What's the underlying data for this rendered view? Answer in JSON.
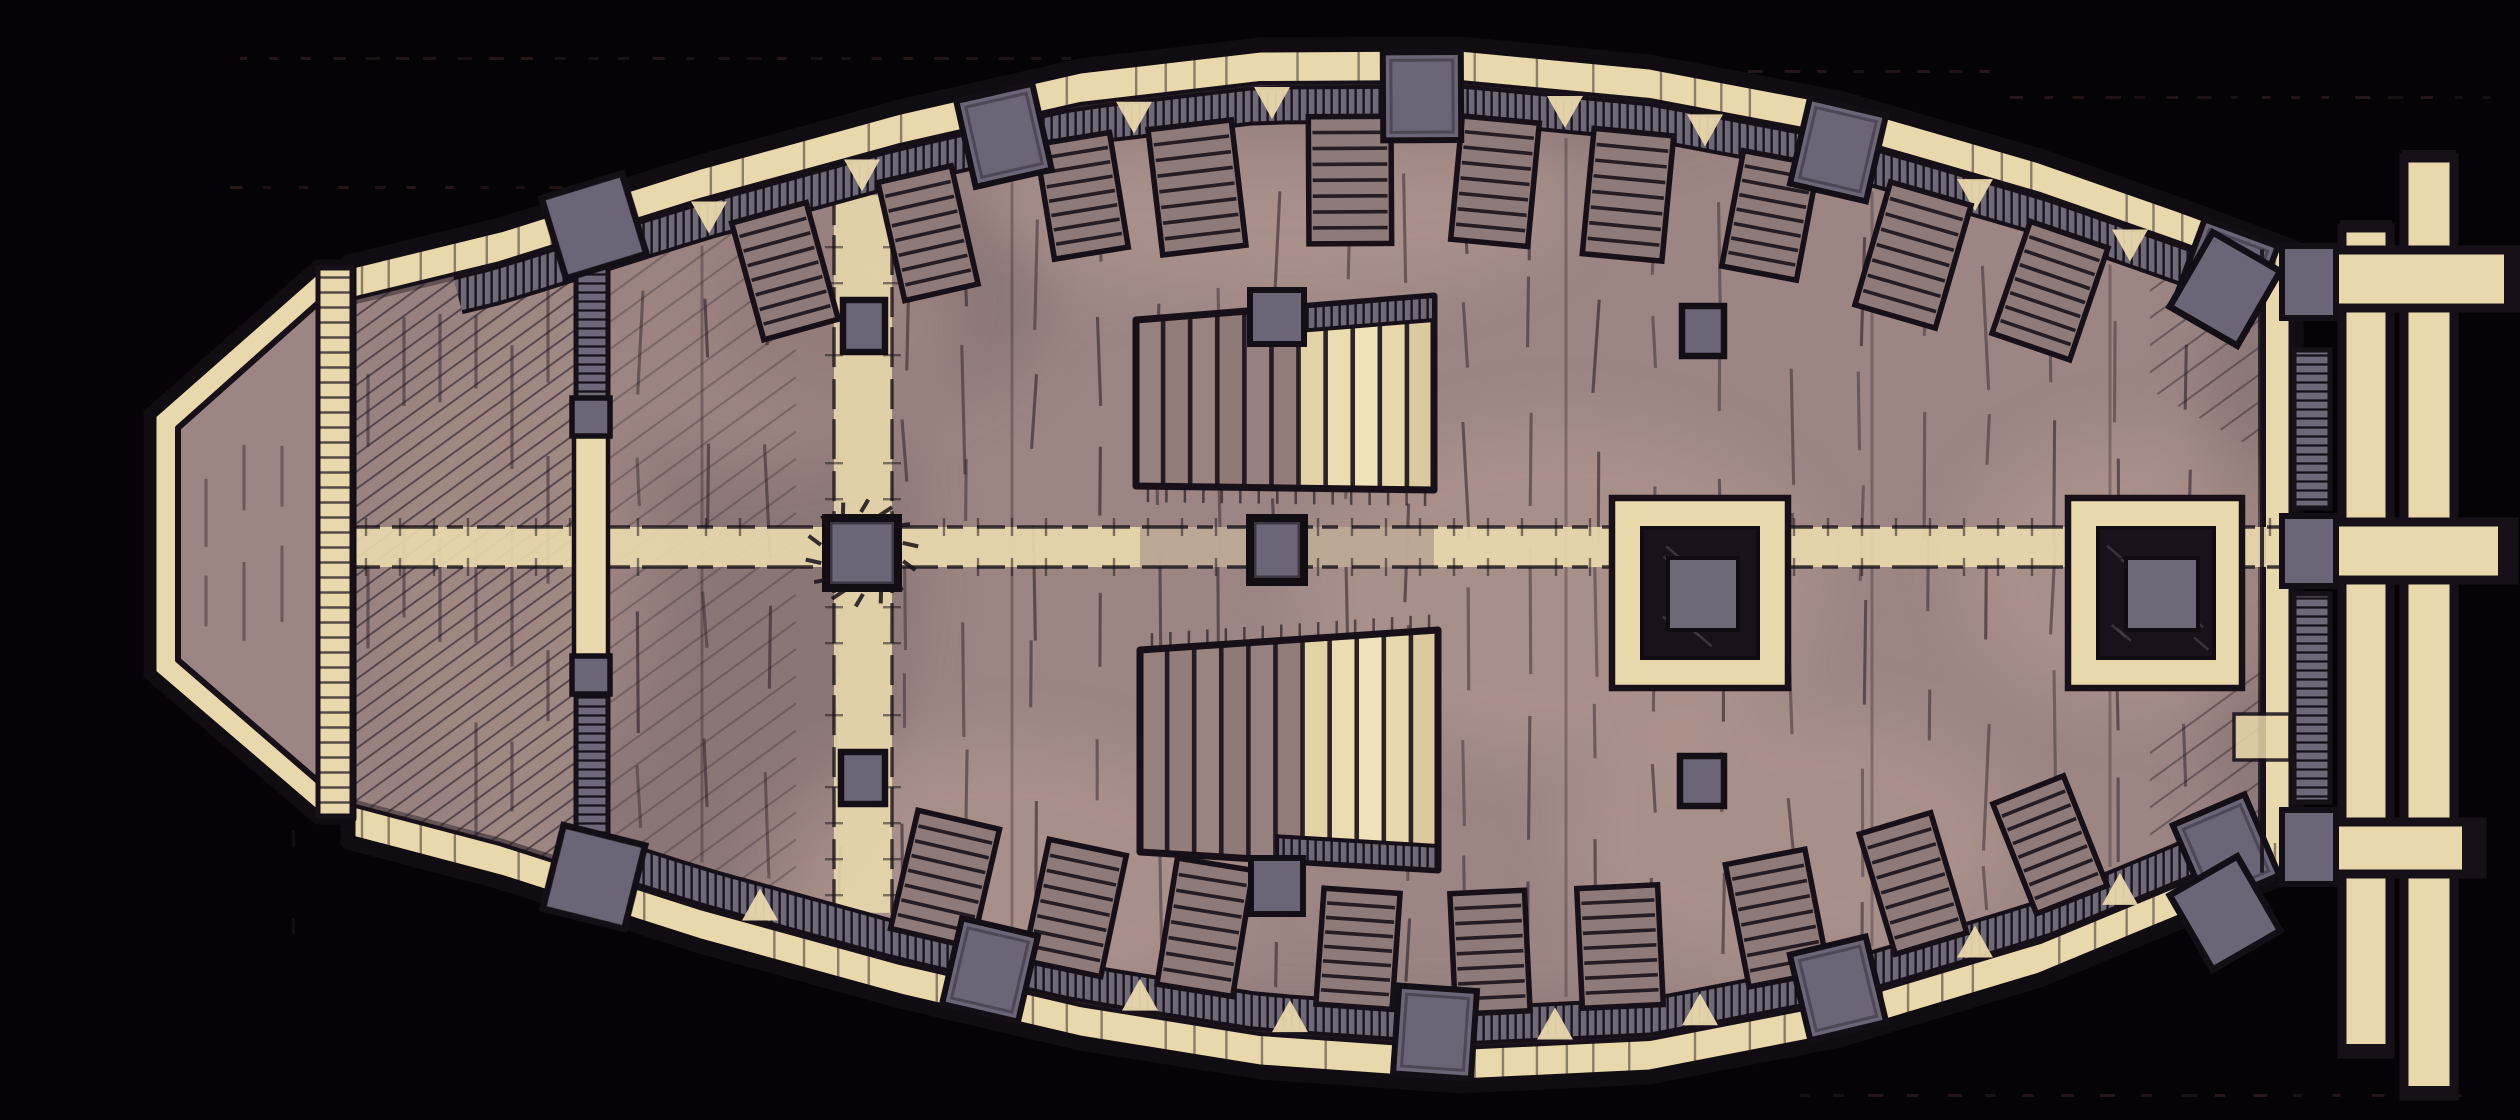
{
  "map": {
    "kind": "ship-deck-battlemap",
    "view": "top-down",
    "width": 2520,
    "height": 1120,
    "palette": {
      "background": "#050306",
      "parchment": "#e9d8ac",
      "parchment_dim": "#d9c7a0",
      "deck": "#9c8583",
      "deck_light": "#cfae9f",
      "deck_dark": "#63525c",
      "foredeck_tint": "#a78e88",
      "grating_fill": "#8e7a78",
      "railing_gray": "#6e6879",
      "block_gray": "#6c6477",
      "hatch_center_gray": "#6e6879",
      "ink": "#171019",
      "ink_soft": "#241a23",
      "dot": "#2c1b1b"
    },
    "background_dots": {
      "rows": [
        {
          "y": 57,
          "x1": 240,
          "x2": 1540,
          "step": 27
        },
        {
          "y": 70,
          "x1": 1560,
          "x2": 1990,
          "step": 29
        },
        {
          "y": 96,
          "x1": 2010,
          "x2": 2505,
          "step": 27
        },
        {
          "y": 186,
          "x1": 230,
          "x2": 585,
          "step": 31
        },
        {
          "y": 1094,
          "x1": 1800,
          "x2": 2470,
          "step": 33
        }
      ],
      "cols": [
        {
          "x": 292,
          "y1": 390,
          "y2": 990,
          "step": 88
        }
      ]
    },
    "hull": {
      "top": [
        [
          348,
          262
        ],
        [
          500,
          225
        ],
        [
          700,
          162
        ],
        [
          900,
          107
        ],
        [
          1080,
          66
        ],
        [
          1260,
          45
        ],
        [
          1460,
          44
        ],
        [
          1650,
          62
        ],
        [
          1840,
          98
        ],
        [
          2040,
          156
        ],
        [
          2180,
          205
        ],
        [
          2296,
          248
        ]
      ],
      "bottom": [
        [
          348,
          842
        ],
        [
          500,
          882
        ],
        [
          700,
          946
        ],
        [
          900,
          1001
        ],
        [
          1080,
          1043
        ],
        [
          1260,
          1072
        ],
        [
          1460,
          1086
        ],
        [
          1650,
          1077
        ],
        [
          1840,
          1040
        ],
        [
          2040,
          980
        ],
        [
          2180,
          922
        ],
        [
          2296,
          872
        ]
      ],
      "deck_inset": 40,
      "left_x": 352,
      "right_x": 2262,
      "railing": {
        "inset": 60,
        "width": 31,
        "top_span": [
          458,
          2248
        ],
        "bottom_span": [
          640,
          2246
        ]
      }
    },
    "bow": {
      "platform_outer": [
        [
          150,
          414
        ],
        [
          318,
          266
        ],
        [
          350,
          266
        ],
        [
          350,
          818
        ],
        [
          318,
          818
        ],
        [
          150,
          674
        ]
      ],
      "platform_inner": [
        [
          178,
          428
        ],
        [
          326,
          296
        ],
        [
          326,
          788
        ],
        [
          178,
          660
        ]
      ],
      "bulkhead": {
        "x": 318,
        "w": 34,
        "y1": 268,
        "y2": 816
      }
    },
    "foredeck": {
      "x1": 352,
      "x2": 606
    },
    "aft_bulkhead": {
      "x": 574,
      "w": 34,
      "top_block": {
        "rect": [
          552,
          184,
          84,
          84
        ],
        "rot": -17
      },
      "bottom_block": {
        "rect": [
          552,
          834,
          84,
          86
        ],
        "rot": 14
      },
      "ladders": [
        [
          576,
          262,
          32,
          138
        ],
        [
          576,
          694,
          32,
          142
        ]
      ],
      "squares": [
        [
          572,
          398,
          38,
          38
        ],
        [
          572,
          656,
          38,
          38
        ]
      ],
      "cream": [
        574,
        436,
        34,
        220
      ]
    },
    "walkway": {
      "y1": 527,
      "y2": 567,
      "x1": 352,
      "x2": 2292,
      "dim_segment": [
        1140,
        1434
      ]
    },
    "mast_band": {
      "x1": 834,
      "x2": 892,
      "edge_gap": 78
    },
    "gun_blocks": {
      "top": [
        1004,
        1422,
        1838,
        2226
      ],
      "bottom": [
        990,
        1435,
        1838,
        2226
      ],
      "w": 78,
      "h": 88,
      "center_inset": 52
    },
    "gratings": {
      "top": [
        785,
        928,
        1082,
        1197,
        1350,
        1495,
        1628,
        1770,
        1913,
        2050
      ],
      "bottom": [
        945,
        1075,
        1205,
        1358,
        1490,
        1620,
        1777,
        1913,
        2050
      ],
      "w": 74,
      "h": 116,
      "stripes": 7,
      "edge_gap": 78
    },
    "embrasures": {
      "top": [
        709,
        862,
        1134,
        1272,
        1565,
        1705,
        1975,
        2130
      ],
      "bottom": [
        760,
        1140,
        1290,
        1555,
        1700,
        1975,
        2120
      ]
    },
    "masts": [
      {
        "name": "foremast",
        "rect": [
          826,
          518,
          72,
          70
        ],
        "rays": 14
      },
      {
        "name": "mainmast",
        "rect": [
          1250,
          518,
          54,
          64
        ],
        "rays": 0
      }
    ],
    "posts": [
      [
        843,
        300,
        42,
        52
      ],
      [
        841,
        752,
        44,
        52
      ],
      [
        1682,
        306,
        42,
        50
      ],
      [
        1680,
        756,
        44,
        50
      ]
    ],
    "stairs": [
      {
        "name": "companionway-upper",
        "poly": [
          [
            1136,
            320
          ],
          [
            1434,
            296
          ],
          [
            1434,
            490
          ],
          [
            1136,
            486
          ]
        ],
        "steps": 11,
        "cream_from": 6,
        "hatch_edge": "top",
        "tick_edge": "bottom",
        "post": [
          1250,
          290,
          54,
          54
        ]
      },
      {
        "name": "companionway-lower",
        "poly": [
          [
            1140,
            650
          ],
          [
            1438,
            630
          ],
          [
            1438,
            870
          ],
          [
            1140,
            852
          ]
        ],
        "steps": 11,
        "cream_from": 6,
        "hatch_edge": "bottom",
        "tick_edge": "top",
        "post": [
          1251,
          858,
          52,
          56
        ]
      }
    ],
    "hatches": [
      {
        "name": "cargo-hatch-left",
        "outer": [
          1612,
          498,
          176,
          190
        ],
        "ring": [
          1642,
          528,
          116,
          130
        ],
        "center": [
          1668,
          558,
          70,
          72
        ]
      },
      {
        "name": "cargo-hatch-right",
        "outer": [
          2068,
          498,
          174,
          190
        ],
        "ring": [
          2098,
          528,
          116,
          130
        ],
        "center": [
          2126,
          558,
          72,
          72
        ]
      }
    ],
    "stern": {
      "transom_lines": [
        2262,
        2292
      ],
      "v_beams": [
        [
          2342,
          228,
          48,
          826
        ],
        [
          2404,
          158,
          50,
          938
        ]
      ],
      "h_beams": [
        [
          2290,
          250,
          228,
          58
        ],
        [
          2290,
          522,
          224,
          58
        ],
        [
          2290,
          822,
          192,
          52
        ]
      ],
      "caps": [
        [
          2504,
          246,
          16,
          66
        ],
        [
          2498,
          518,
          18,
          66
        ],
        [
          2462,
          818,
          18,
          60
        ],
        [
          2340,
          220,
          52,
          12
        ],
        [
          2340,
          1044,
          52,
          12
        ],
        [
          2402,
          150,
          54,
          12
        ],
        [
          2402,
          1086,
          54,
          12
        ]
      ],
      "junctions": [
        [
          2282,
          246,
          54,
          72
        ],
        [
          2282,
          516,
          54,
          70
        ],
        [
          2282,
          810,
          54,
          74
        ]
      ],
      "ladders": [
        [
          2294,
          350,
          36,
          158
        ],
        [
          2294,
          594,
          36,
          208
        ]
      ],
      "bench": [
        2234,
        714,
        56,
        46
      ],
      "corner_blocks": [
        {
          "rect": [
            2186,
            246,
            78,
            86
          ],
          "rot": 30
        },
        {
          "rect": [
            2186,
            870,
            78,
            86
          ],
          "rot": -30
        }
      ]
    },
    "texture": {
      "plank": {
        "x1": 640,
        "x2": 2248,
        "gap": 58,
        "row_h": 112,
        "len_min": 48,
        "len_max": 130
      },
      "foredeck_cols": {
        "x1": 368,
        "x2": 590,
        "gap": 36
      },
      "bow_cols": {
        "x1": 206,
        "x2": 330,
        "gap": 38
      },
      "long_lines": [
        702,
        1012,
        1566,
        1872,
        2110
      ]
    },
    "shading": {
      "light": [
        [
          760,
          330,
          190,
          130
        ],
        [
          1290,
          200,
          280,
          100
        ],
        [
          1560,
          590,
          260,
          170
        ],
        [
          1790,
          840,
          230,
          130
        ],
        [
          2140,
          570,
          180,
          140
        ],
        [
          1000,
          880,
          240,
          140
        ],
        [
          520,
          560,
          130,
          230
        ]
      ],
      "dark": [
        [
          1300,
          95,
          430,
          70
        ],
        [
          1330,
          1068,
          430,
          70
        ],
        [
          420,
          560,
          110,
          330
        ],
        [
          2270,
          560,
          75,
          330
        ],
        [
          880,
          300,
          170,
          110
        ],
        [
          700,
          560,
          220,
          380
        ]
      ],
      "light_op": 0.26,
      "dark_op": 0.3
    }
  }
}
